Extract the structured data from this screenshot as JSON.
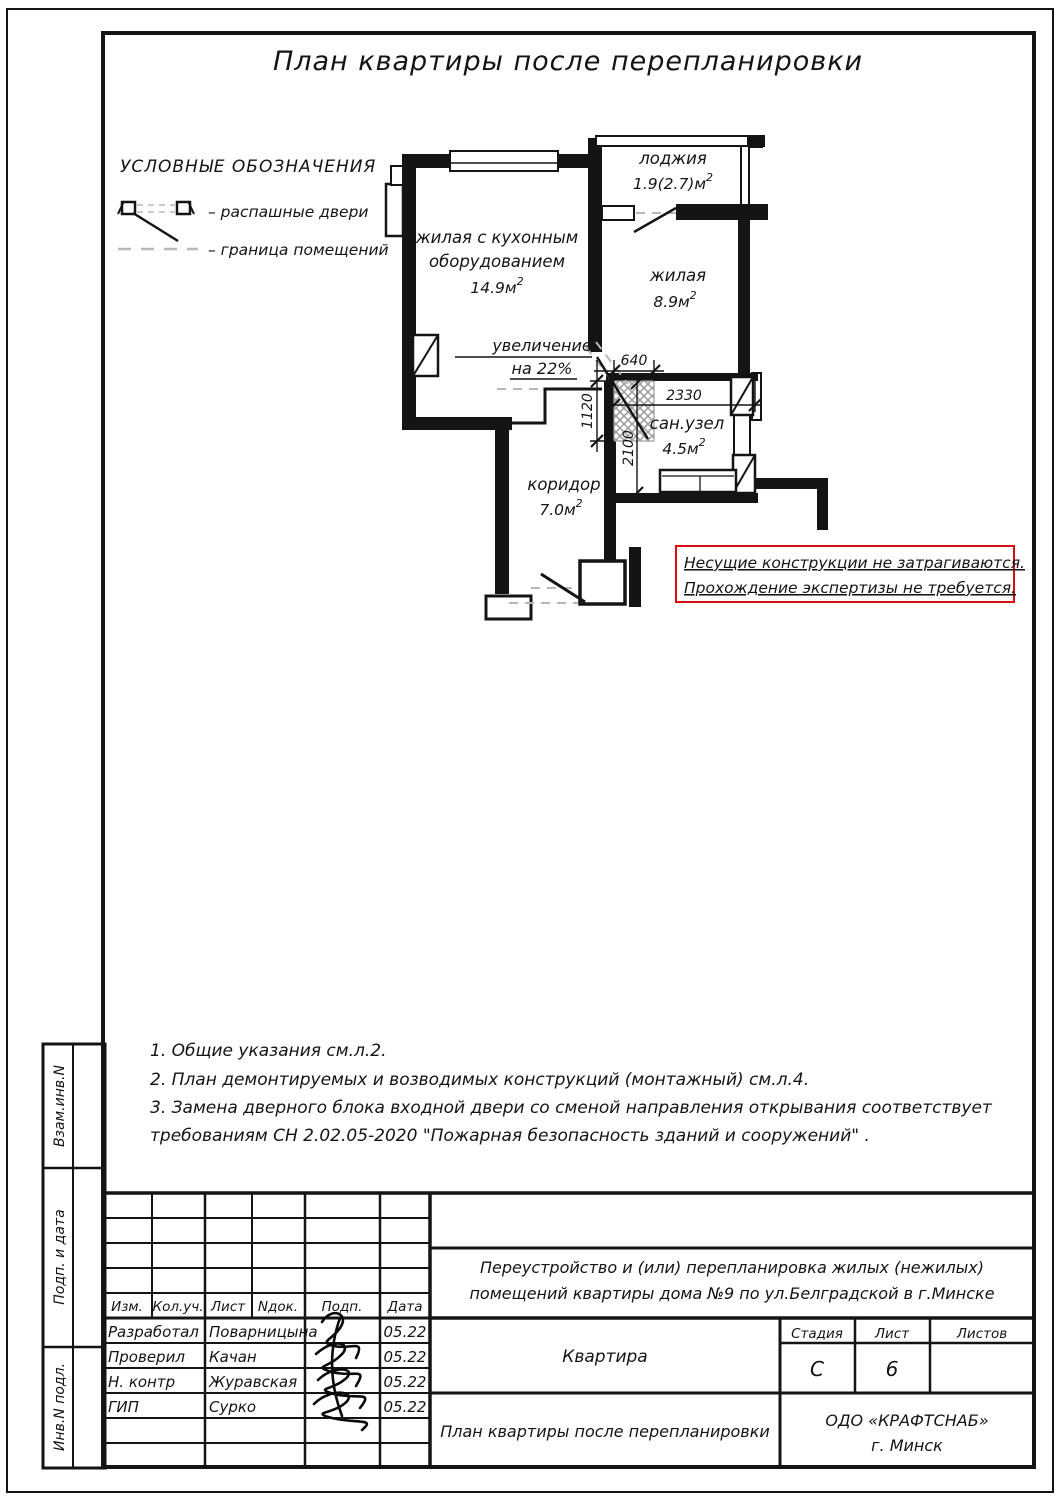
{
  "title": "План квартиры после перепланировки",
  "legend": {
    "heading": "УСЛОВНЫЕ ОБОЗНАЧЕНИЯ",
    "swing_doors": "– распашные двери",
    "room_boundary": "– граница помещений"
  },
  "plan": {
    "loggia": {
      "name": "лоджия",
      "area": "1.9(2.7)м",
      "sup": "2"
    },
    "kitchen_living": {
      "name1": "жилая с кухонным",
      "name2": "оборудованием",
      "area": "14.9м",
      "sup": "2"
    },
    "living": {
      "name": "жилая",
      "area": "8.9м",
      "sup": "2"
    },
    "bathroom": {
      "name": "сан.узел",
      "area": "4.5м",
      "sup": "2"
    },
    "corridor": {
      "name": "коридор",
      "area": "7.0м",
      "sup": "2"
    },
    "increase1": "увеличение",
    "increase2": "на 22%",
    "dims": {
      "top": "640",
      "width": "2330",
      "left": "1120",
      "height": "2100"
    }
  },
  "warning": {
    "line1": "Несущие конструкции не затрагиваются.",
    "line2": "Прохождение экспертизы не требуется.",
    "color": "#d90f0f"
  },
  "notes": [
    "1. Общие указания см.л.2.",
    "2. План демонтируемых и возводимых конструкций (монтажный) см.л.4.",
    "3. Замена дверного блока входной двери со сменой направления открывания соответствует",
    "требованиям СН 2.02.05-2020 \"Пожарная безопасность зданий и сооружений\" ."
  ],
  "stamp": {
    "cols": {
      "izm": "Изм.",
      "koluch": "Кол.уч.",
      "list": "Лист",
      "ndok": "Nдок.",
      "podp": "Подп.",
      "data": "Дата"
    },
    "rows": [
      {
        "role": "Разработал",
        "name": "Поварницына",
        "date": "05.22"
      },
      {
        "role": "Проверил",
        "name": "Качан",
        "date": "05.22"
      },
      {
        "role": "Н. контр",
        "name": "Журавская",
        "date": "05.22"
      },
      {
        "role": "ГИП",
        "name": "Сурко",
        "date": "05.22"
      }
    ],
    "project1": "Переустройство и (или) перепланировка жилых (нежилых)",
    "project2": "помещений квартиры дома №9 по ул.Белградской в г.Минске",
    "object": "Квартира",
    "sheet_title": "План квартиры после перепланировки",
    "stage_label": "Стадия",
    "sheet_label": "Лист",
    "sheets_label": "Листов",
    "stage": "С",
    "sheet": "6",
    "sheets": "",
    "company1": "ОДО «КРАФТСНАБ»",
    "company2": "г. Минск",
    "side": {
      "vzam": "Взам.инв.N",
      "podp_data": "Подп. и дата",
      "inv": "Инв.N подл."
    }
  }
}
